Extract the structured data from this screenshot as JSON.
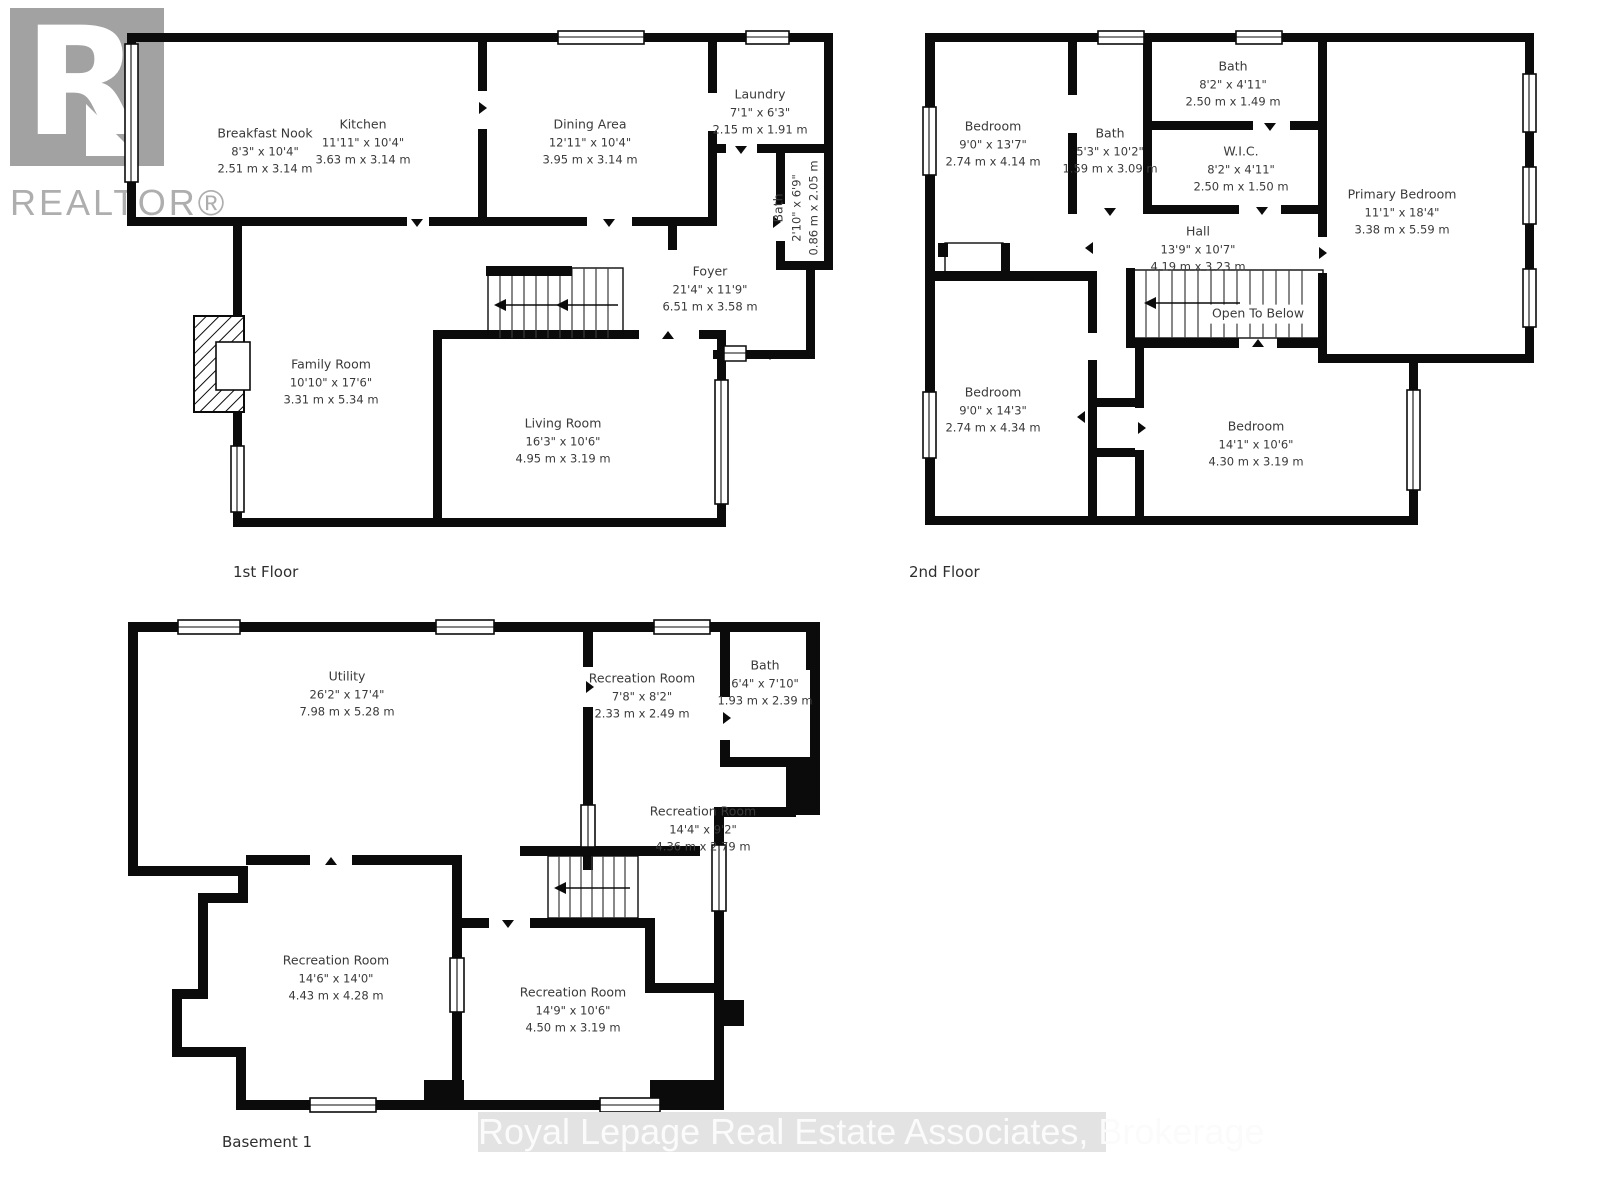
{
  "branding": {
    "realtor_r": "R",
    "realtor_label": "REALTOR®",
    "watermark": "Royal Lepage Real Estate Associates, Brokerage"
  },
  "floors": [
    {
      "label": "1st Floor",
      "rooms": [
        {
          "name": "Breakfast Nook",
          "imperial": "8'3\" x 10'4\"",
          "metric": "2.51 m x 3.14 m"
        },
        {
          "name": "Kitchen",
          "imperial": "11'11\" x 10'4\"",
          "metric": "3.63 m x 3.14 m"
        },
        {
          "name": "Dining Area",
          "imperial": "12'11\" x 10'4\"",
          "metric": "3.95 m x 3.14 m"
        },
        {
          "name": "Laundry",
          "imperial": "7'1\" x 6'3\"",
          "metric": "2.15 m x 1.91 m"
        },
        {
          "name": "Bath",
          "imperial": "2'10\" x 6'9\"",
          "metric": "0.86 m x 2.05 m"
        },
        {
          "name": "Foyer",
          "imperial": "21'4\" x 11'9\"",
          "metric": "6.51 m x 3.58 m"
        },
        {
          "name": "Family Room",
          "imperial": "10'10\" x 17'6\"",
          "metric": "3.31 m x 5.34 m"
        },
        {
          "name": "Living Room",
          "imperial": "16'3\" x 10'6\"",
          "metric": "4.95 m x 3.19 m"
        }
      ]
    },
    {
      "label": "2nd Floor",
      "rooms": [
        {
          "name": "Bedroom",
          "imperial": "9'0\" x 13'7\"",
          "metric": "2.74 m x 4.14 m"
        },
        {
          "name": "Bath",
          "imperial": "8'2\" x 4'11\"",
          "metric": "2.50 m x 1.49 m"
        },
        {
          "name": "Bath",
          "imperial": "5'3\" x 10'2\"",
          "metric": "1.59 m x 3.09 m"
        },
        {
          "name": "W.I.C.",
          "imperial": "8'2\" x 4'11\"",
          "metric": "2.50 m x 1.50 m"
        },
        {
          "name": "Primary Bedroom",
          "imperial": "11'1\" x 18'4\"",
          "metric": "3.38 m x 5.59 m"
        },
        {
          "name": "Hall",
          "imperial": "13'9\" x 10'7\"",
          "metric": "4.19 m x 3.23 m"
        },
        {
          "name": "Open To Below",
          "imperial": "",
          "metric": ""
        },
        {
          "name": "Bedroom",
          "imperial": "9'0\" x 14'3\"",
          "metric": "2.74 m x 4.34 m"
        },
        {
          "name": "Bedroom",
          "imperial": "14'1\" x 10'6\"",
          "metric": "4.30 m x 3.19 m"
        }
      ]
    },
    {
      "label": "Basement 1",
      "rooms": [
        {
          "name": "Utility",
          "imperial": "26'2\" x 17'4\"",
          "metric": "7.98 m x 5.28 m"
        },
        {
          "name": "Recreation Room",
          "imperial": "7'8\" x 8'2\"",
          "metric": "2.33 m x 2.49 m"
        },
        {
          "name": "Bath",
          "imperial": "6'4\" x 7'10\"",
          "metric": "1.93 m x 2.39 m"
        },
        {
          "name": "Recreation Room",
          "imperial": "14'4\" x 9'2\"",
          "metric": "4.36 m x 2.79 m"
        },
        {
          "name": "Recreation Room",
          "imperial": "14'6\" x 14'0\"",
          "metric": "4.43 m x 4.28 m"
        },
        {
          "name": "Recreation Room",
          "imperial": "14'9\" x 10'6\"",
          "metric": "4.50 m x 3.19 m"
        }
      ]
    }
  ]
}
